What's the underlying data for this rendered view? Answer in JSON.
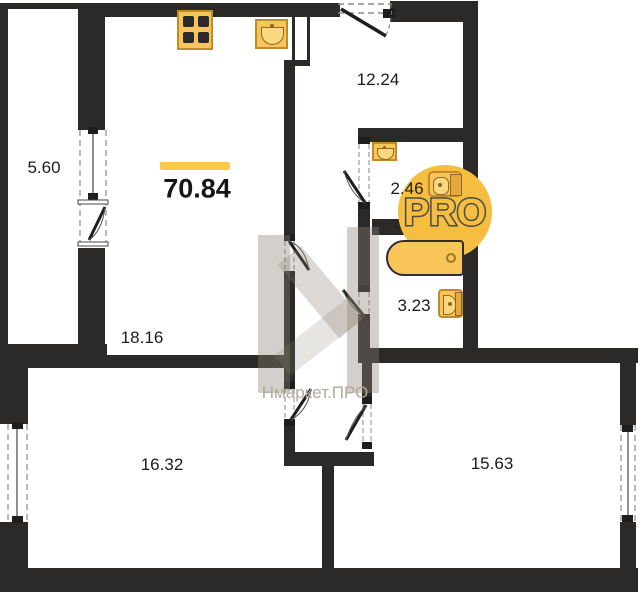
{
  "floorplan": {
    "title": "apartment floor plan",
    "total_area": "70.84",
    "rooms": {
      "balcony": "5.60",
      "living_room": "18.16",
      "hallway": "12.24",
      "wc": "2.46",
      "bathroom": "3.23",
      "bedroom_left": "16.32",
      "bedroom_right": "15.63"
    },
    "watermark": {
      "logo_text": "PRO",
      "brand_text": "Нмаркет.ПРО"
    },
    "icons": [
      "stove-icon",
      "kitchen-sink-icon",
      "washbasin-icon",
      "toilet-icon",
      "bathtub-icon"
    ],
    "colors": {
      "wall": "#2b2a28",
      "fixture": "#f9c55b",
      "fixture_border": "#c18a2b",
      "accent_circle": "#f6be41",
      "total_bar": "#ffc84b"
    }
  }
}
